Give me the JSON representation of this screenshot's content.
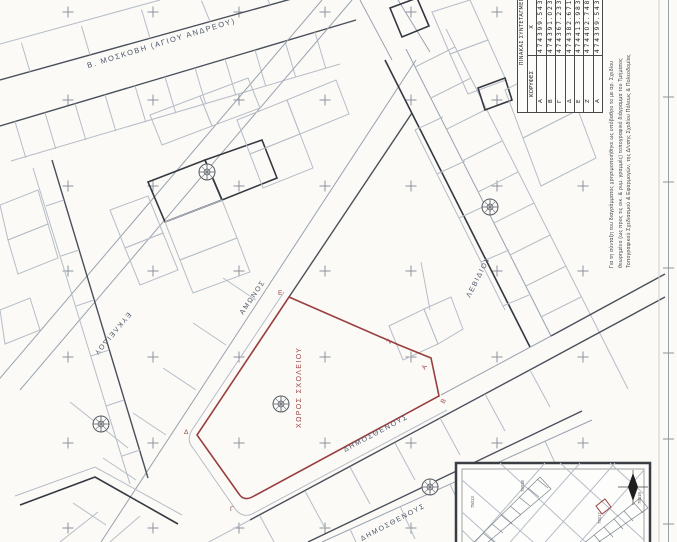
{
  "streets": {
    "moskovi": "Β. ΜΟΣΚΟΒΗ (ΑΓΙΟΥ ΑΝΔΡΕΟΥ)",
    "amonos": "ΑΜΩΝΟΣ",
    "levidiou": "ΛΕΒΙΔΙΟΥ",
    "dimosthenous": "ΔΗΜΟΣΘΕΝΟΥΣ",
    "dimosthenous_2": "ΔΗΜΟΣΘΕΝΟΥΣ",
    "eukleidou": "ΕΥΚΛΕΙΔΟΥ"
  },
  "site": {
    "label": "ΧΩΡΟΣ ΣΧΟΛΕΙΟΥ",
    "vertex_a": "Α",
    "vertex_b": "Β",
    "vertex_g": "Γ",
    "vertex_d": "Δ",
    "vertex_e": "Ε",
    "vertex_z": "Ζ"
  },
  "coordinates_table": {
    "title": "ΠΙΝΑΚΑΣ ΣΥΝΤΕΤΑΓΜΕΝΩΝ",
    "col_vertices": "ΚΟΡΥΦΕΣ",
    "col_x": "Χ",
    "rows": [
      {
        "v": "Α",
        "x": "474399.543"
      },
      {
        "v": "Β",
        "x": "474391.023"
      },
      {
        "v": "Γ",
        "x": "474367.233"
      },
      {
        "v": "Δ",
        "x": "474382.671"
      },
      {
        "v": "Ε",
        "x": "474413.983"
      },
      {
        "v": "Ζ",
        "x": "474402.748"
      },
      {
        "v": "Α",
        "x": "474399.543"
      }
    ]
  },
  "side_note": {
    "line1": "Για τη σύνταξη του διαγράμματος χρησιμοποιήθηκε ως υπόβαθρο το με αρ. Σχεδίου",
    "line2": "θεωρημένο (ως προς τις οικ. & ρυμ. γραμμές) τοπογραφικό διάγραμμα του Τμήματος",
    "line3": "Τοπογραφικού Σχεδιασμού & Εφαρμογών, της Δ/νσης Σχεδίου Πόλεως & Πολεοδομίας"
  },
  "inset": {
    "block_numbers": [
      "75013",
      "75018",
      "75017",
      "75019"
    ]
  },
  "colors": {
    "site_outline": "#993f3f",
    "ink": "#3d424a",
    "light_line": "#b6bdc7",
    "grid_cross": "#8d939c"
  }
}
